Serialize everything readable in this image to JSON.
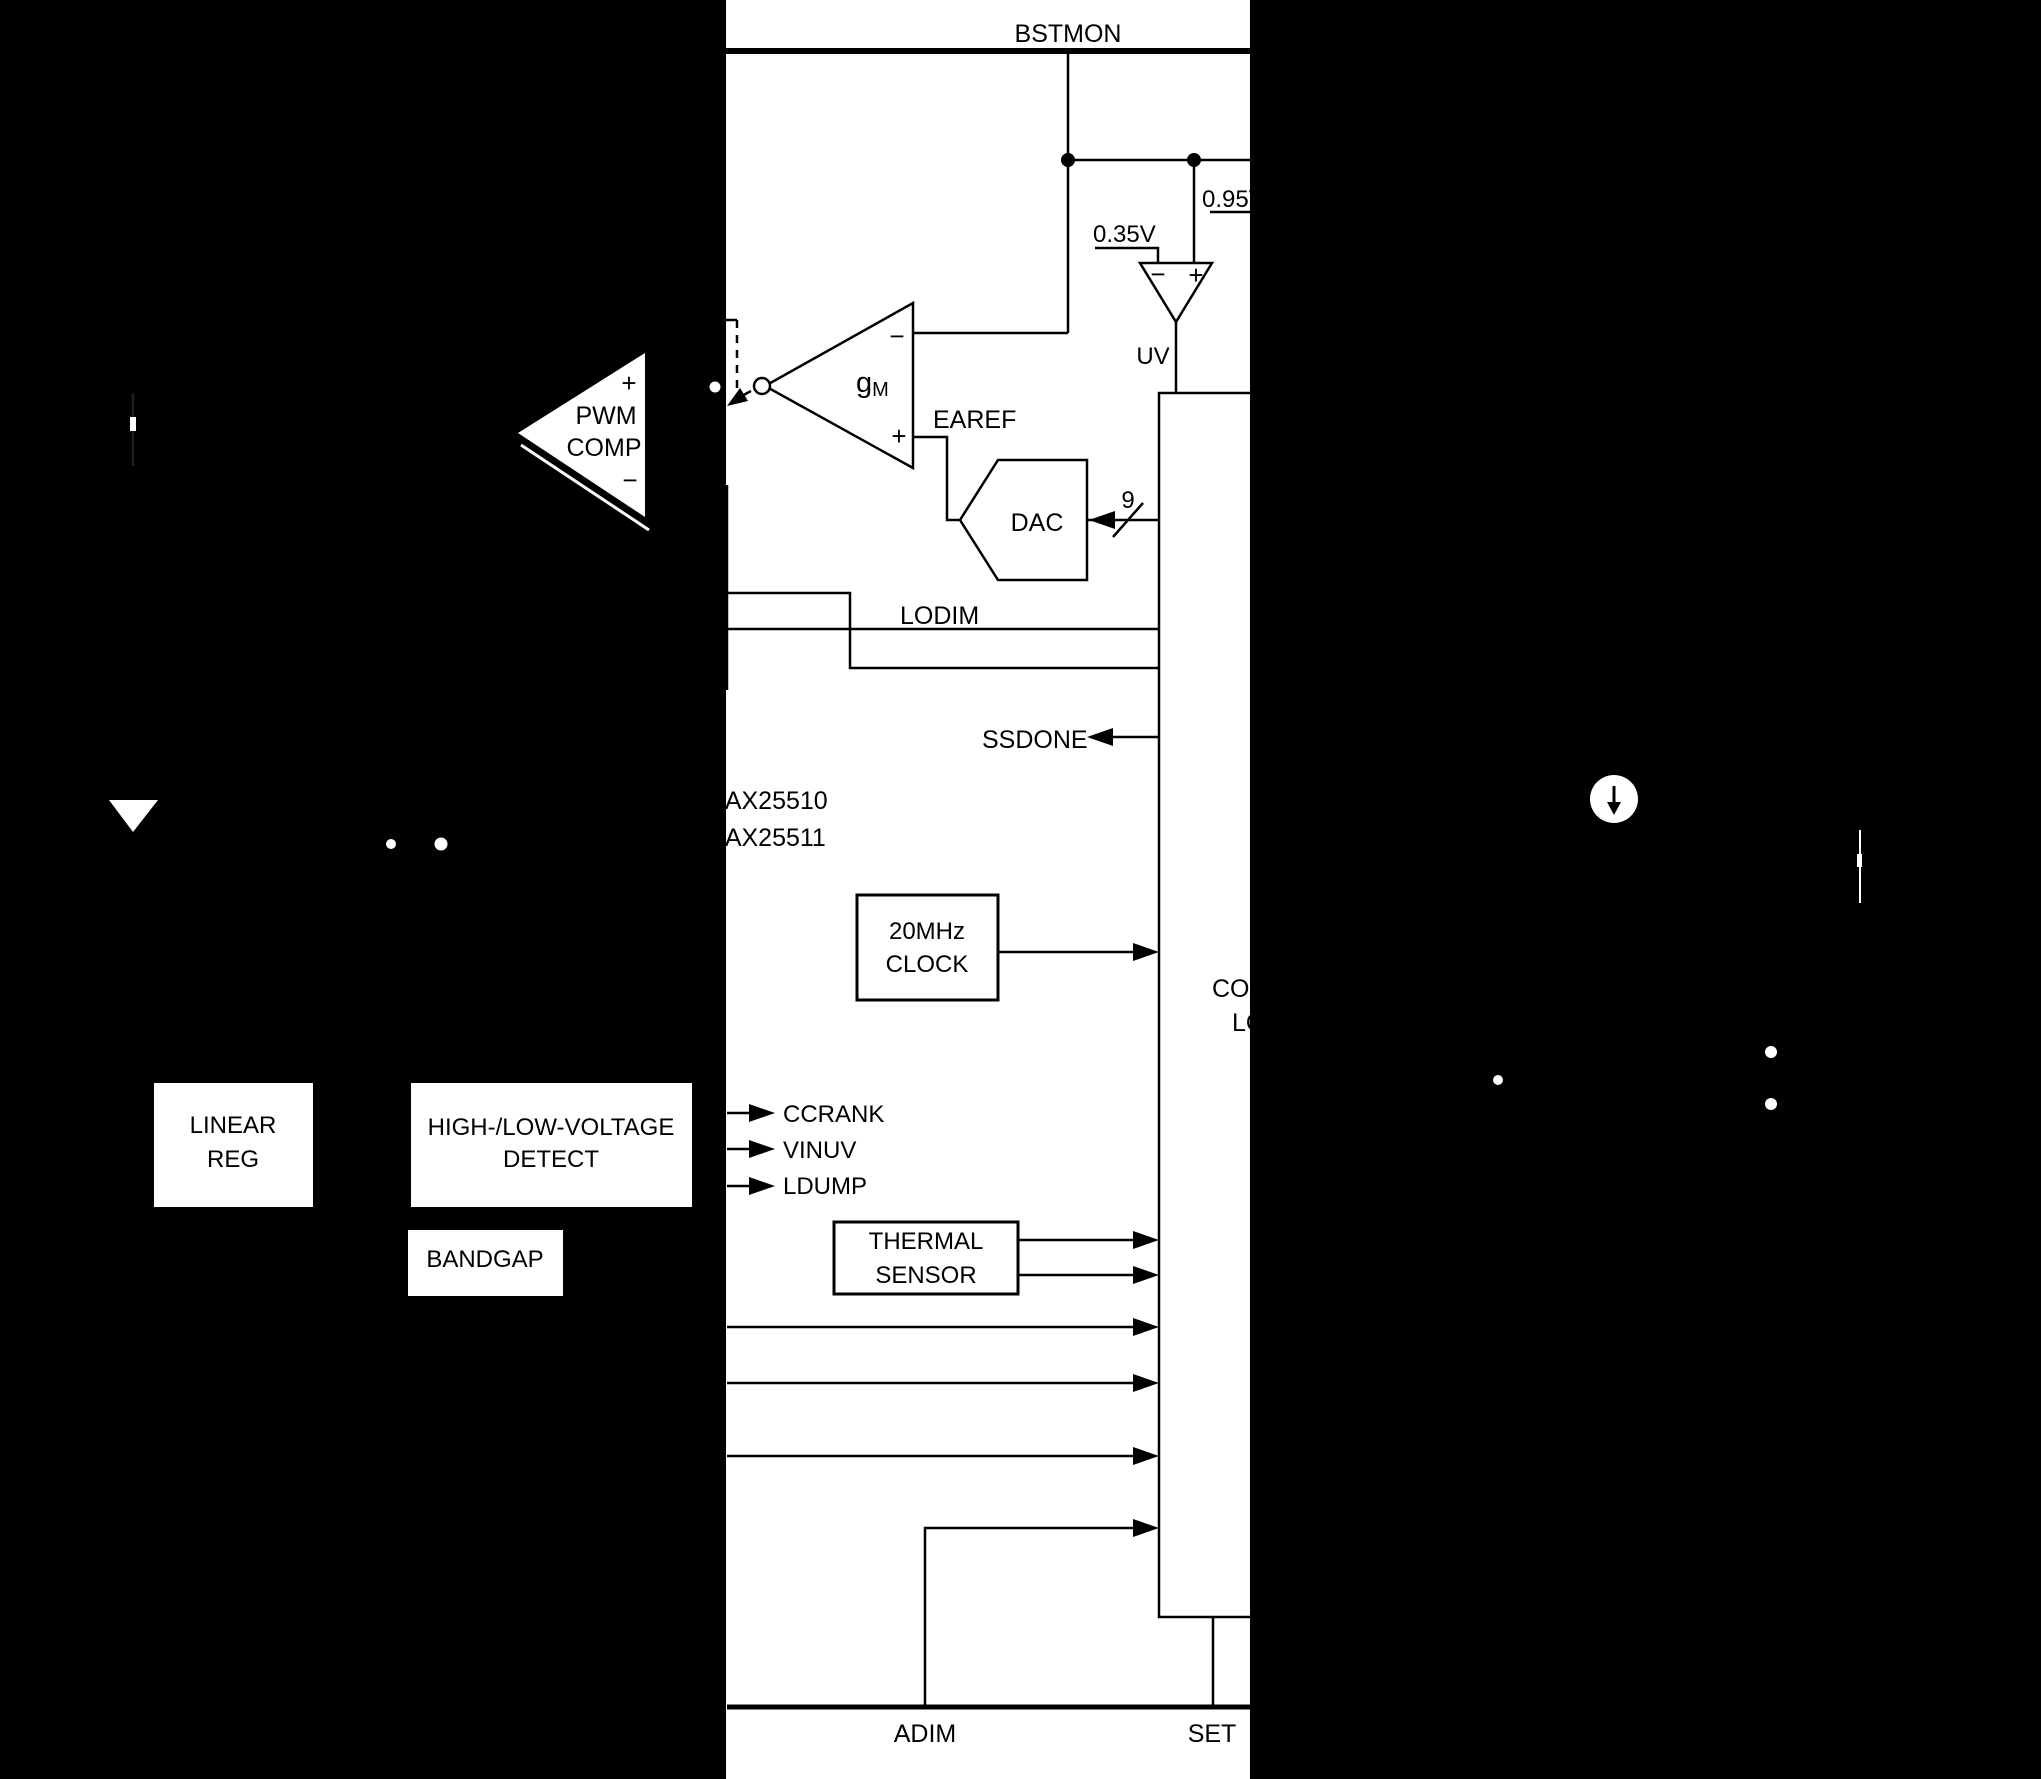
{
  "colors": {
    "background": "#000000",
    "paper": "#ffffff",
    "ink": "#000000",
    "faint_line": "#1e1e1e"
  },
  "top_net": {
    "label": "BSTMON"
  },
  "references": {
    "v095": "0.95V",
    "v035": "0.35V",
    "uv": "UV",
    "bus_width": "9"
  },
  "error_amp": {
    "g": "g",
    "sub": "M",
    "minus": "−",
    "plus": "+",
    "ref_label": "EAREF"
  },
  "pwm_comp": {
    "plus": "+",
    "line1": "PWM",
    "line2": "COMP",
    "minus": "−"
  },
  "dac": {
    "label": "DAC"
  },
  "lodim": {
    "label": "LODIM"
  },
  "ssdone": {
    "label": "SSDONE"
  },
  "part_numbers": {
    "line1": "MAX25510",
    "line2": "MAX25511"
  },
  "clock_block": {
    "line1": "20MHz",
    "line2": "CLOCK"
  },
  "control_block": {
    "line1": "CONTROL",
    "line2": "LOGIC"
  },
  "detect_signals": {
    "s1": "CCRANK",
    "s2": "VINUV",
    "s3": "LDUMP"
  },
  "thermal_block": {
    "line1": "THERMAL",
    "line2": "SENSOR"
  },
  "linear_block": {
    "line1": "LINEAR",
    "line2": "REG"
  },
  "hv_block": {
    "line1": "HIGH-/LOW-VOLTAGE",
    "line2": "DETECT"
  },
  "bandgap_block": {
    "label": "BANDGAP"
  },
  "bottom_pins": {
    "adim": "ADIM",
    "set": "SET"
  }
}
